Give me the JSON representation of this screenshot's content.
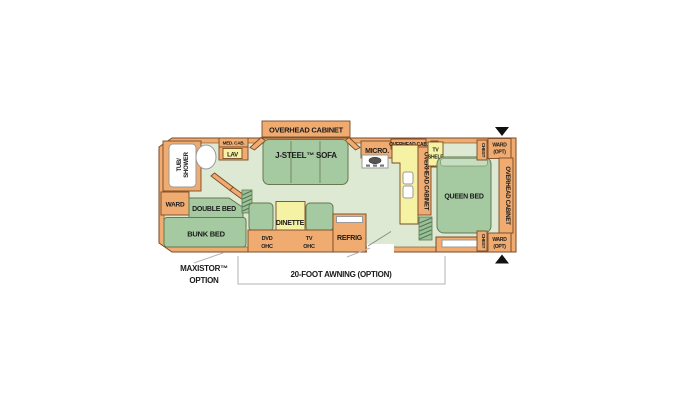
{
  "colors": {
    "wall_fill": "#efab70",
    "wall_border": "#7b4a26",
    "floor": "#dde9d2",
    "furniture_green": "#a5c9a0",
    "furniture_light_green": "#c6ddc0",
    "counter_yellow": "#f6f2a3",
    "fixture_white": "#ffffff",
    "annotation_line": "#b3b3b3",
    "arrow_black": "#111111"
  },
  "plan": {
    "bath": {
      "tub_line1": "TUB/",
      "tub_line2": "SHOWER",
      "med_cab": "MED. CAB.",
      "lav": "LAV"
    },
    "front_bedroom": {
      "ward": "WARD",
      "double_bed": "DOUBLE BED",
      "bunk_bed": "BUNK BED"
    },
    "living": {
      "overhead_cabinet": "OVERHEAD CABINET",
      "sofa": "J-STEEL™ SOFA",
      "dinette": "DINETTE",
      "dvd_ohc": {
        "line1": "DVD",
        "line2": "OHC"
      },
      "tv_ohc": {
        "line1": "TV",
        "line2": "OHC"
      },
      "refrig": "REFRIG"
    },
    "kitchen": {
      "micro": "MICRO.",
      "overhead_cab": "OVERHEAD CAB.",
      "overhead_cabinet": "OVERHEAD CABINET"
    },
    "rear_bedroom": {
      "tv_shelf": {
        "line1": "TV",
        "line2": "SHELF"
      },
      "queen_bed": "QUEEN BED",
      "chest_top": "CHEST",
      "chest_bottom": "CHEST",
      "ward_opt_top": {
        "line1": "WARD",
        "line2": "(OPT)"
      },
      "ward_opt_bottom": {
        "line1": "WARD",
        "line2": "(OPT)"
      },
      "overhead_cabinet": "OVERHEAD CABINET"
    },
    "annotations": {
      "maxistor": {
        "line1": "MAXISTOR™",
        "line2": "OPTION"
      },
      "awning": "20-FOOT AWNING (OPTION)"
    }
  }
}
